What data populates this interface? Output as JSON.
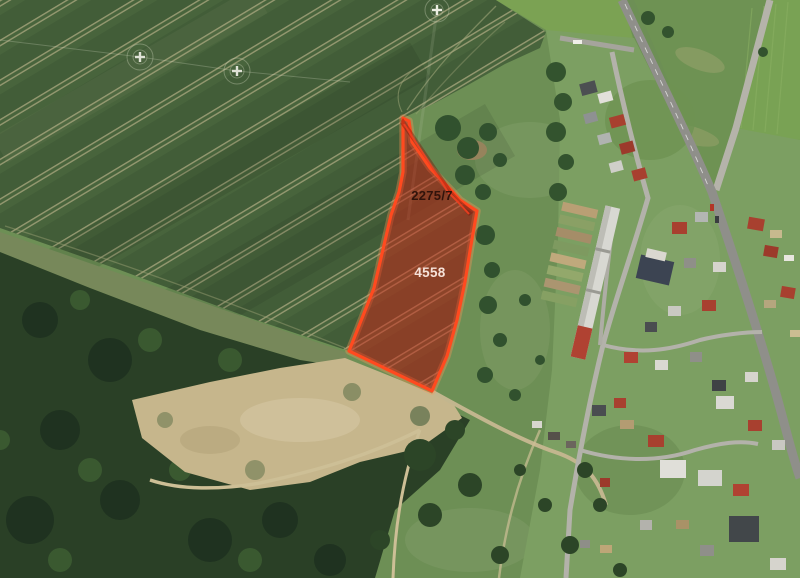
{
  "map": {
    "description": "Aerial satellite view with cadastral parcel highlight",
    "base_land_color": "#6d8f55",
    "field_color": "#48643c",
    "forest_color": "#2a4026",
    "bare_ground_color": "#c6b68c",
    "road_color": "#92938c"
  },
  "parcel_overlay": {
    "outline_color": "#ff4a1f",
    "outline_width": "3.2",
    "glow_color": "rgba(255,150,90,0.35)",
    "fill_color": "rgba(208,36,22,0.5)",
    "divider_color": "#f04020",
    "band_color": "rgba(125,15,5,0.4)",
    "outline_points": "403,118 409,121 412,142 430,168 452,191 460,200 477,211 471,245 465,282 457,320 447,356 432,391 349,351 374,288 391,215 399,192 403,172",
    "divider_points": "404,124 448,192 456,200 469,214",
    "band_points": "403,118 452,191 460,200 474,212 469,216 455,200 448,191 400,123",
    "parcels": [
      {
        "label": "2275/7",
        "x": 432,
        "y": 200,
        "color": "#31130b",
        "font_size": "13"
      },
      {
        "label": "4558",
        "x": 430,
        "y": 277,
        "color": "#f6e2d9",
        "font_size": "13.5"
      }
    ]
  }
}
